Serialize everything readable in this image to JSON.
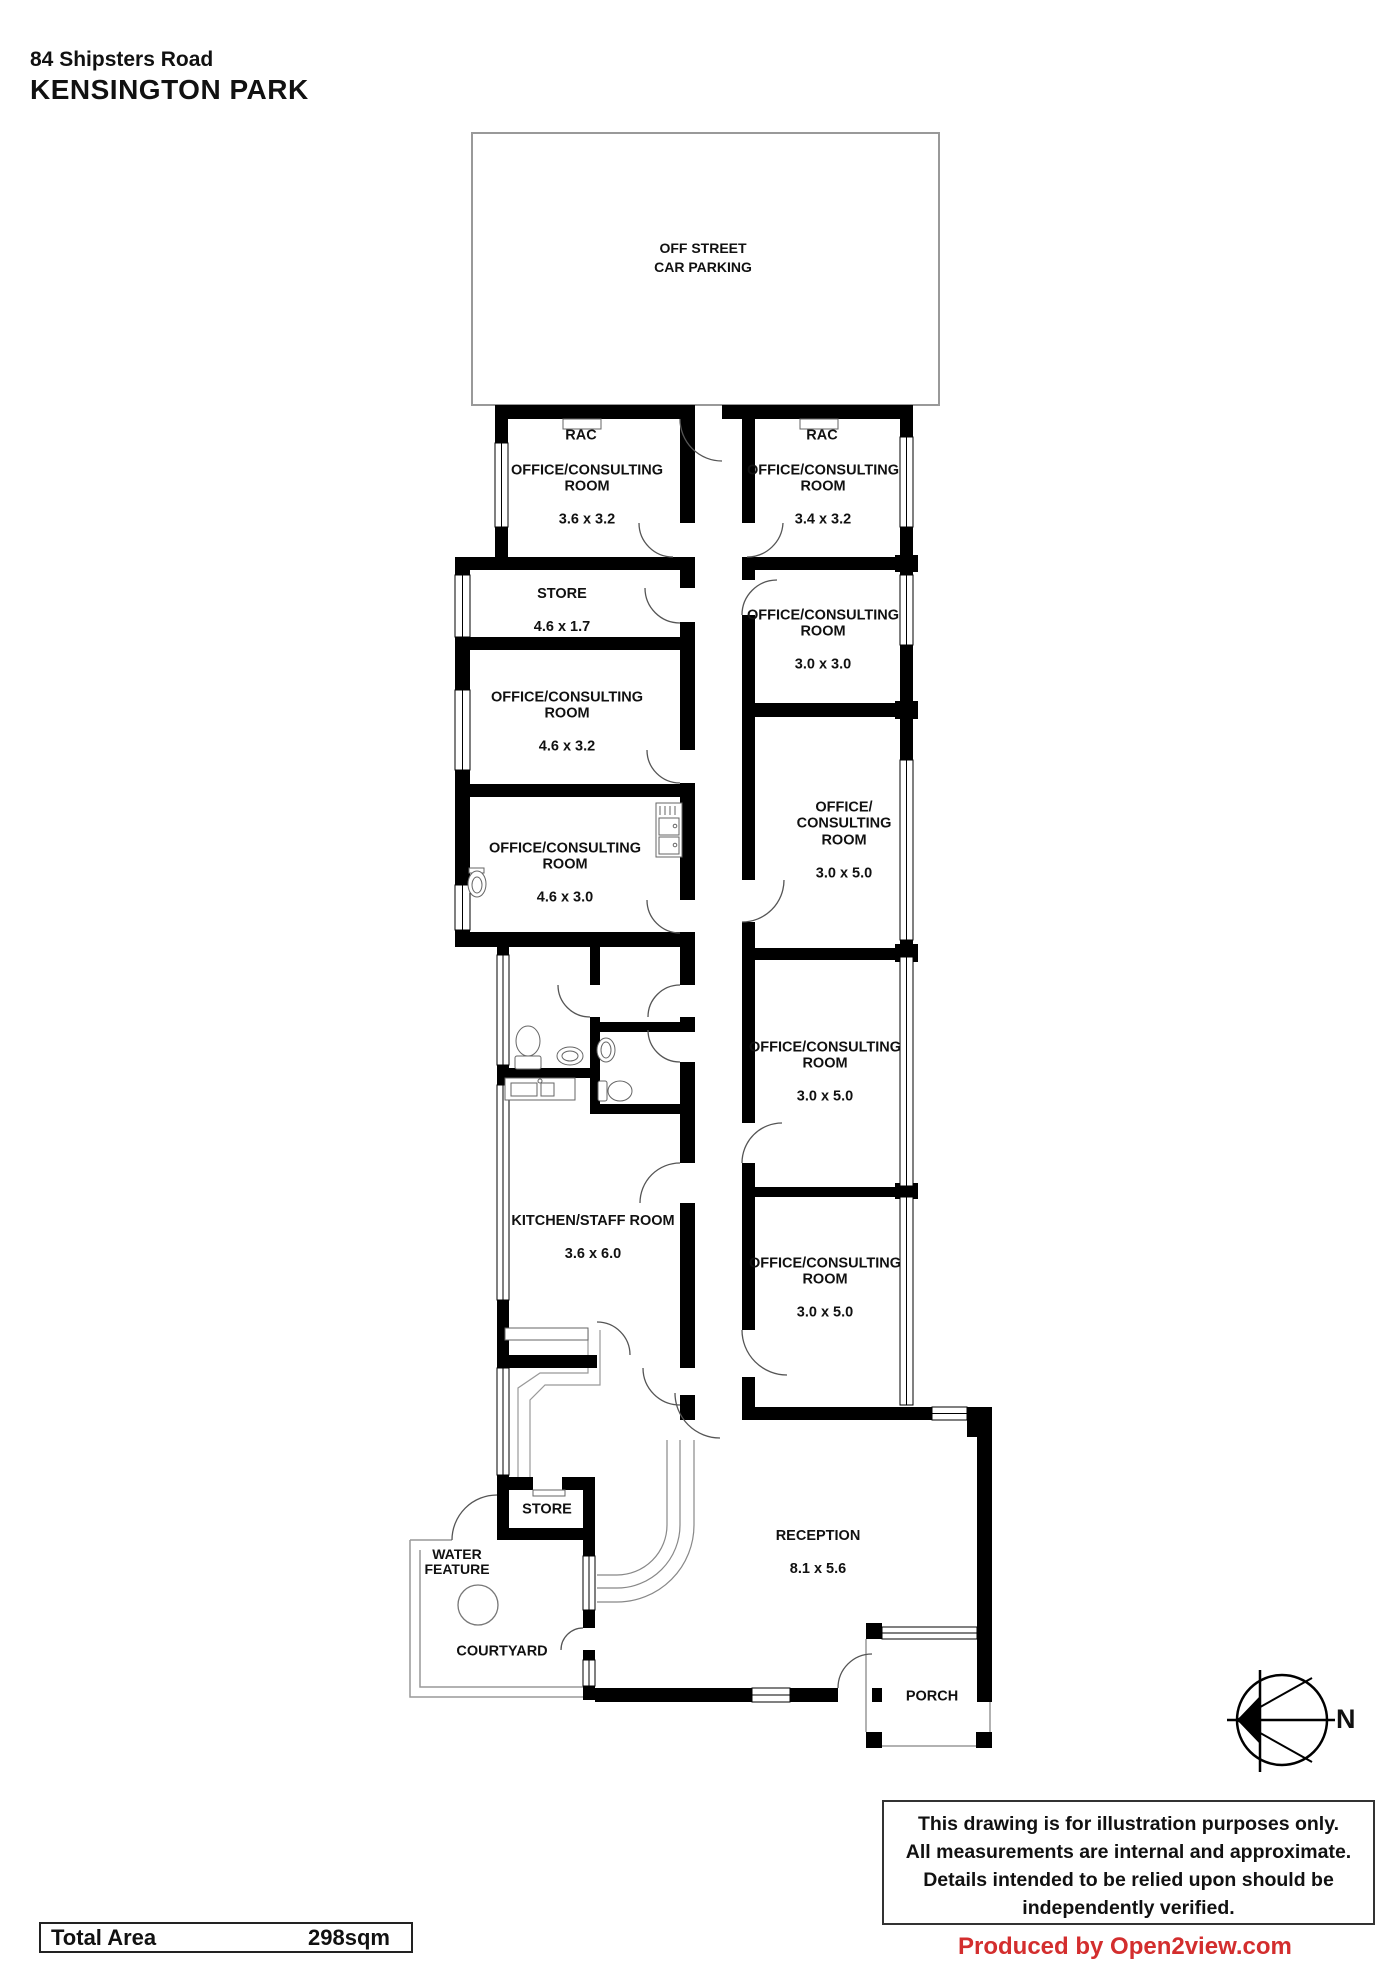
{
  "title": {
    "line1": "84 Shipsters Road",
    "line2": "KENSINGTON PARK"
  },
  "parking": {
    "label": "OFF STREET\nCAR PARKING"
  },
  "rooms": {
    "rac_left": {
      "name": "RAC"
    },
    "rac_right": {
      "name": "RAC"
    },
    "office_top_left": {
      "name": "OFFICE/CONSULTING\nROOM",
      "dims": "3.6 x 3.2"
    },
    "office_top_right": {
      "name": "OFFICE/CONSULTING\nROOM",
      "dims": "3.4 x 3.2"
    },
    "store_upper": {
      "name": "STORE",
      "dims": "4.6 x 1.7"
    },
    "office_3030": {
      "name": "OFFICE/CONSULTING\nROOM",
      "dims": "3.0 x 3.0"
    },
    "office_mid_left": {
      "name": "OFFICE/CONSULTING\nROOM",
      "dims": "4.6 x 3.2"
    },
    "office_lower_left": {
      "name": "OFFICE/CONSULTING\nROOM",
      "dims": "4.6 x 3.0"
    },
    "office_3050_a": {
      "name": "OFFICE/\nCONSULTING\nROOM",
      "dims": "3.0 x 5.0"
    },
    "office_3050_b": {
      "name": "OFFICE/CONSULTING\nROOM",
      "dims": "3.0 x 5.0"
    },
    "kitchen": {
      "name": "KITCHEN/STAFF ROOM",
      "dims": "3.6 x 6.0"
    },
    "office_3050_c": {
      "name": "OFFICE/CONSULTING\nROOM",
      "dims": "3.0 x 5.0"
    },
    "store_lower": {
      "name": "STORE"
    },
    "water_feature": {
      "name": "WATER\nFEATURE"
    },
    "courtyard": {
      "name": "COURTYARD"
    },
    "reception": {
      "name": "RECEPTION",
      "dims": "8.1 x 5.6"
    },
    "porch": {
      "name": "PORCH"
    }
  },
  "compass": {
    "north_label": "N"
  },
  "footer": {
    "total_area_label": "Total Area",
    "total_area_value": "298sqm",
    "disclaimer": "This drawing is for illustration purposes only.\nAll measurements are internal and approximate.\nDetails intended to be relied upon should be\nindependently verified.",
    "produced_by": "Produced by Open2view.com"
  },
  "colors": {
    "wall": "#000000",
    "produced_by_red": "#d32e2e",
    "outline_gray": "#999999"
  }
}
